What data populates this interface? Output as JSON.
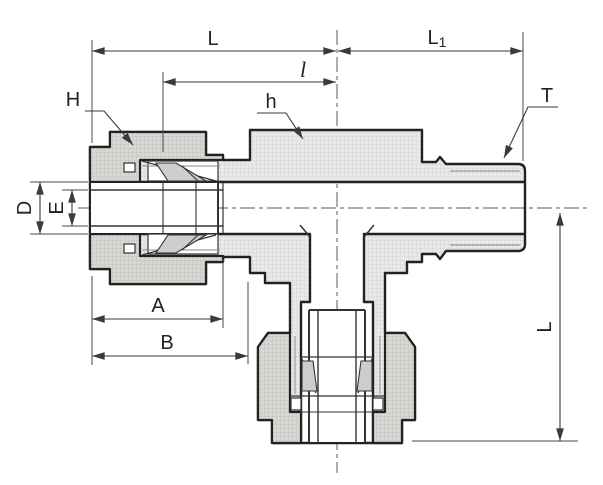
{
  "drawing": {
    "type": "technical-section-drawing",
    "subject": "male-run-tee-compression-tube-fitting",
    "colors": {
      "outline": "#222222",
      "body_fill": "#e9e9e7",
      "nut_fill": "#d7d7d4",
      "hatch_line_light": "#cfcfcc",
      "hatch_line_dark": "#bdbdba",
      "dimension": "#3a3a3a",
      "background": "#ffffff"
    },
    "labels": {
      "L": "L",
      "l": "l",
      "L1_base": "L",
      "L1_sub": "1",
      "H": "H",
      "h": "h",
      "T": "T",
      "D": "D",
      "E": "E",
      "A": "A",
      "B": "B",
      "L_side": "L"
    }
  }
}
